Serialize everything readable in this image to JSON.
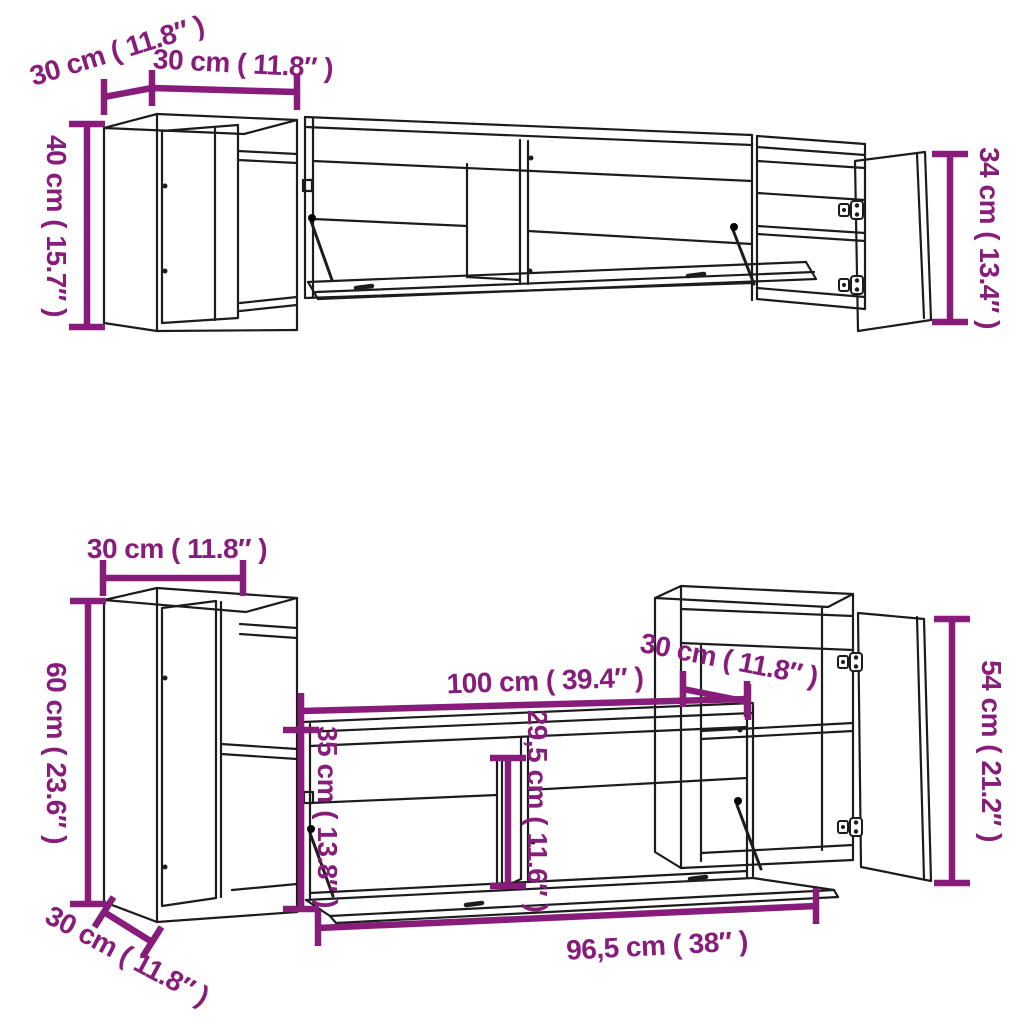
{
  "diagram": {
    "title": "tv-wall-cabinet-set-dimension-diagram",
    "dimension_color": "#871c7a",
    "line_color": "#1c1c1c",
    "background": "#ffffff",
    "top_assembly": {
      "depth_label": "30 cm ( 11.8″ )",
      "width_label": "30 cm ( 11.8″ )",
      "left_height_label": "40 cm ( 15.7″ )",
      "right_height_label": "34 cm ( 13.4″ )"
    },
    "bottom_assembly": {
      "width_label": "30 cm ( 11.8″ )",
      "left_height_label": "60 cm ( 23.6″ )",
      "depth_label": "30 cm ( 11.8″ )",
      "tv_width_label": "100 cm ( 39.4″ )",
      "right_depth_label": "30 cm ( 11.8″ )",
      "right_height_label": "54 cm ( 21.2″ )",
      "tv_inner_height_label": "35 cm ( 13.8″ )",
      "opening_height_label": "29,5 cm ( 11.6″ )",
      "flap_width_label": "96,5 cm ( 38″ )"
    }
  }
}
